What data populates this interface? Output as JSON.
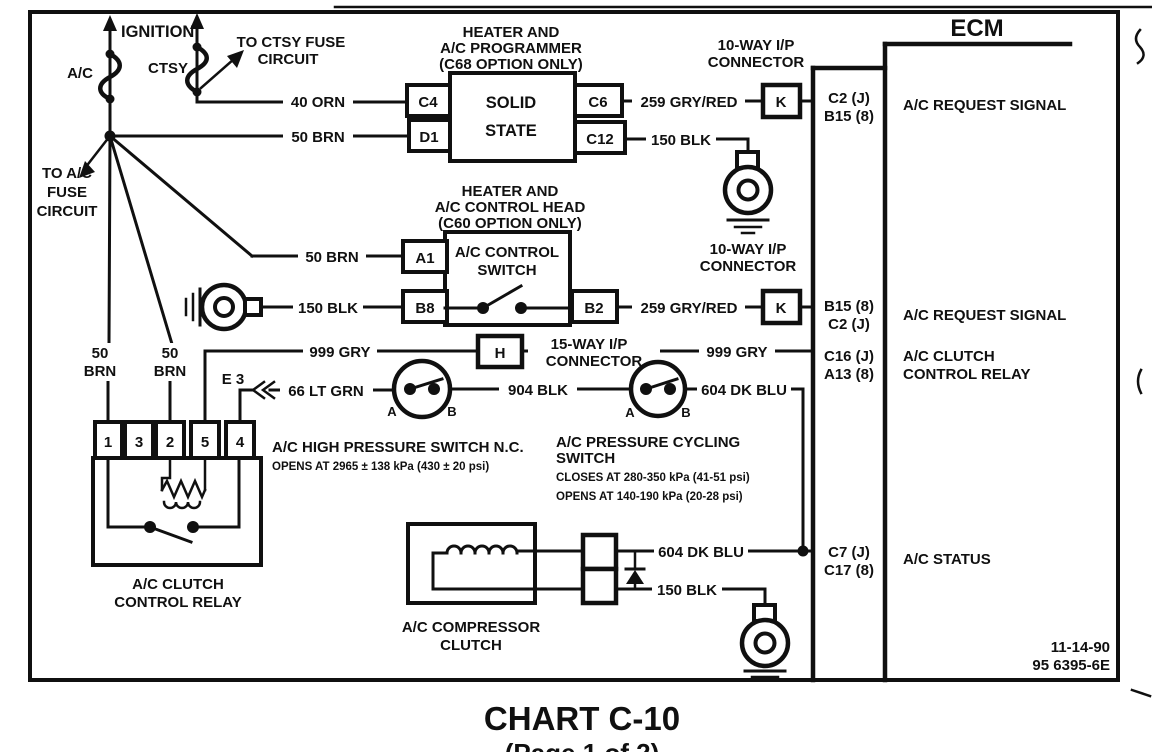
{
  "title": "CHART C-10",
  "subtitle": "(Page 1 of 2)",
  "doc": {
    "date": "11-14-90",
    "number": "95 6395-6E"
  },
  "power": {
    "ignition": "IGNITION",
    "ac_fuse": "A/C",
    "ctsy_fuse": "CTSY",
    "to_ctsy": [
      "TO CTSY FUSE",
      "CIRCUIT"
    ],
    "to_ac": [
      "TO A/C",
      "FUSE",
      "CIRCUIT"
    ]
  },
  "wires": {
    "orn40": "40 ORN",
    "brn50": "50 BRN",
    "brn50a": "50",
    "brn50b": "BRN",
    "blk150": "150 BLK",
    "gryred259": "259 GRY/RED",
    "gry999": "999 GRY",
    "ltgrn66": "66 LT GRN",
    "blk904": "904 BLK",
    "dkblu604": "604 DK BLU"
  },
  "connectors": {
    "ip10": [
      "10-WAY I/P",
      "CONNECTOR"
    ],
    "ip15": [
      "15-WAY I/P",
      "CONNECTOR"
    ],
    "k": "K",
    "h": "H",
    "e3": "E 3"
  },
  "programmer": {
    "heading": [
      "HEATER AND",
      "A/C PROGRAMMER",
      "(C68 OPTION ONLY)"
    ],
    "body": [
      "SOLID",
      "STATE"
    ],
    "pins": {
      "c4": "C4",
      "d1": "D1",
      "c6": "C6",
      "c12": "C12"
    }
  },
  "control_head": {
    "heading": [
      "HEATER AND",
      "A/C CONTROL HEAD",
      "(C60 OPTION ONLY)"
    ],
    "body": [
      "A/C CONTROL",
      "SWITCH"
    ],
    "pins": {
      "a1": "A1",
      "b8": "B8",
      "b2": "B2"
    }
  },
  "hp_switch": {
    "title": "A/C HIGH PRESSURE SWITCH N.C.",
    "spec": "OPENS AT 2965 ± 138 kPa (430 ± 20 psi)",
    "a": "A",
    "b": "B"
  },
  "cycling_switch": {
    "title": [
      "A/C PRESSURE CYCLING",
      "SWITCH"
    ],
    "spec1": "CLOSES AT 280-350 kPa (41-51 psi)",
    "spec2": "OPENS AT 140-190 kPa (20-28 psi)",
    "a": "A",
    "b": "B"
  },
  "relay": {
    "pins": [
      "1",
      "3",
      "2",
      "5",
      "4"
    ],
    "label": [
      "A/C CLUTCH",
      "CONTROL RELAY"
    ]
  },
  "compressor": {
    "label": [
      "A/C COMPRESSOR",
      "CLUTCH"
    ]
  },
  "ecm": {
    "title": "ECM",
    "rows": [
      {
        "pins": [
          "C2 (J)",
          "B15 (8)"
        ],
        "signal": [
          "A/C REQUEST SIGNAL"
        ]
      },
      {
        "pins": [
          "B15 (8)",
          "C2 (J)"
        ],
        "signal": [
          "A/C REQUEST SIGNAL"
        ]
      },
      {
        "pins": [
          "C16 (J)",
          "A13 (8)"
        ],
        "signal": [
          "A/C CLUTCH",
          "CONTROL RELAY"
        ]
      },
      {
        "pins": [
          "C7 (J)",
          "C17 (8)"
        ],
        "signal": [
          "A/C STATUS"
        ]
      }
    ]
  }
}
